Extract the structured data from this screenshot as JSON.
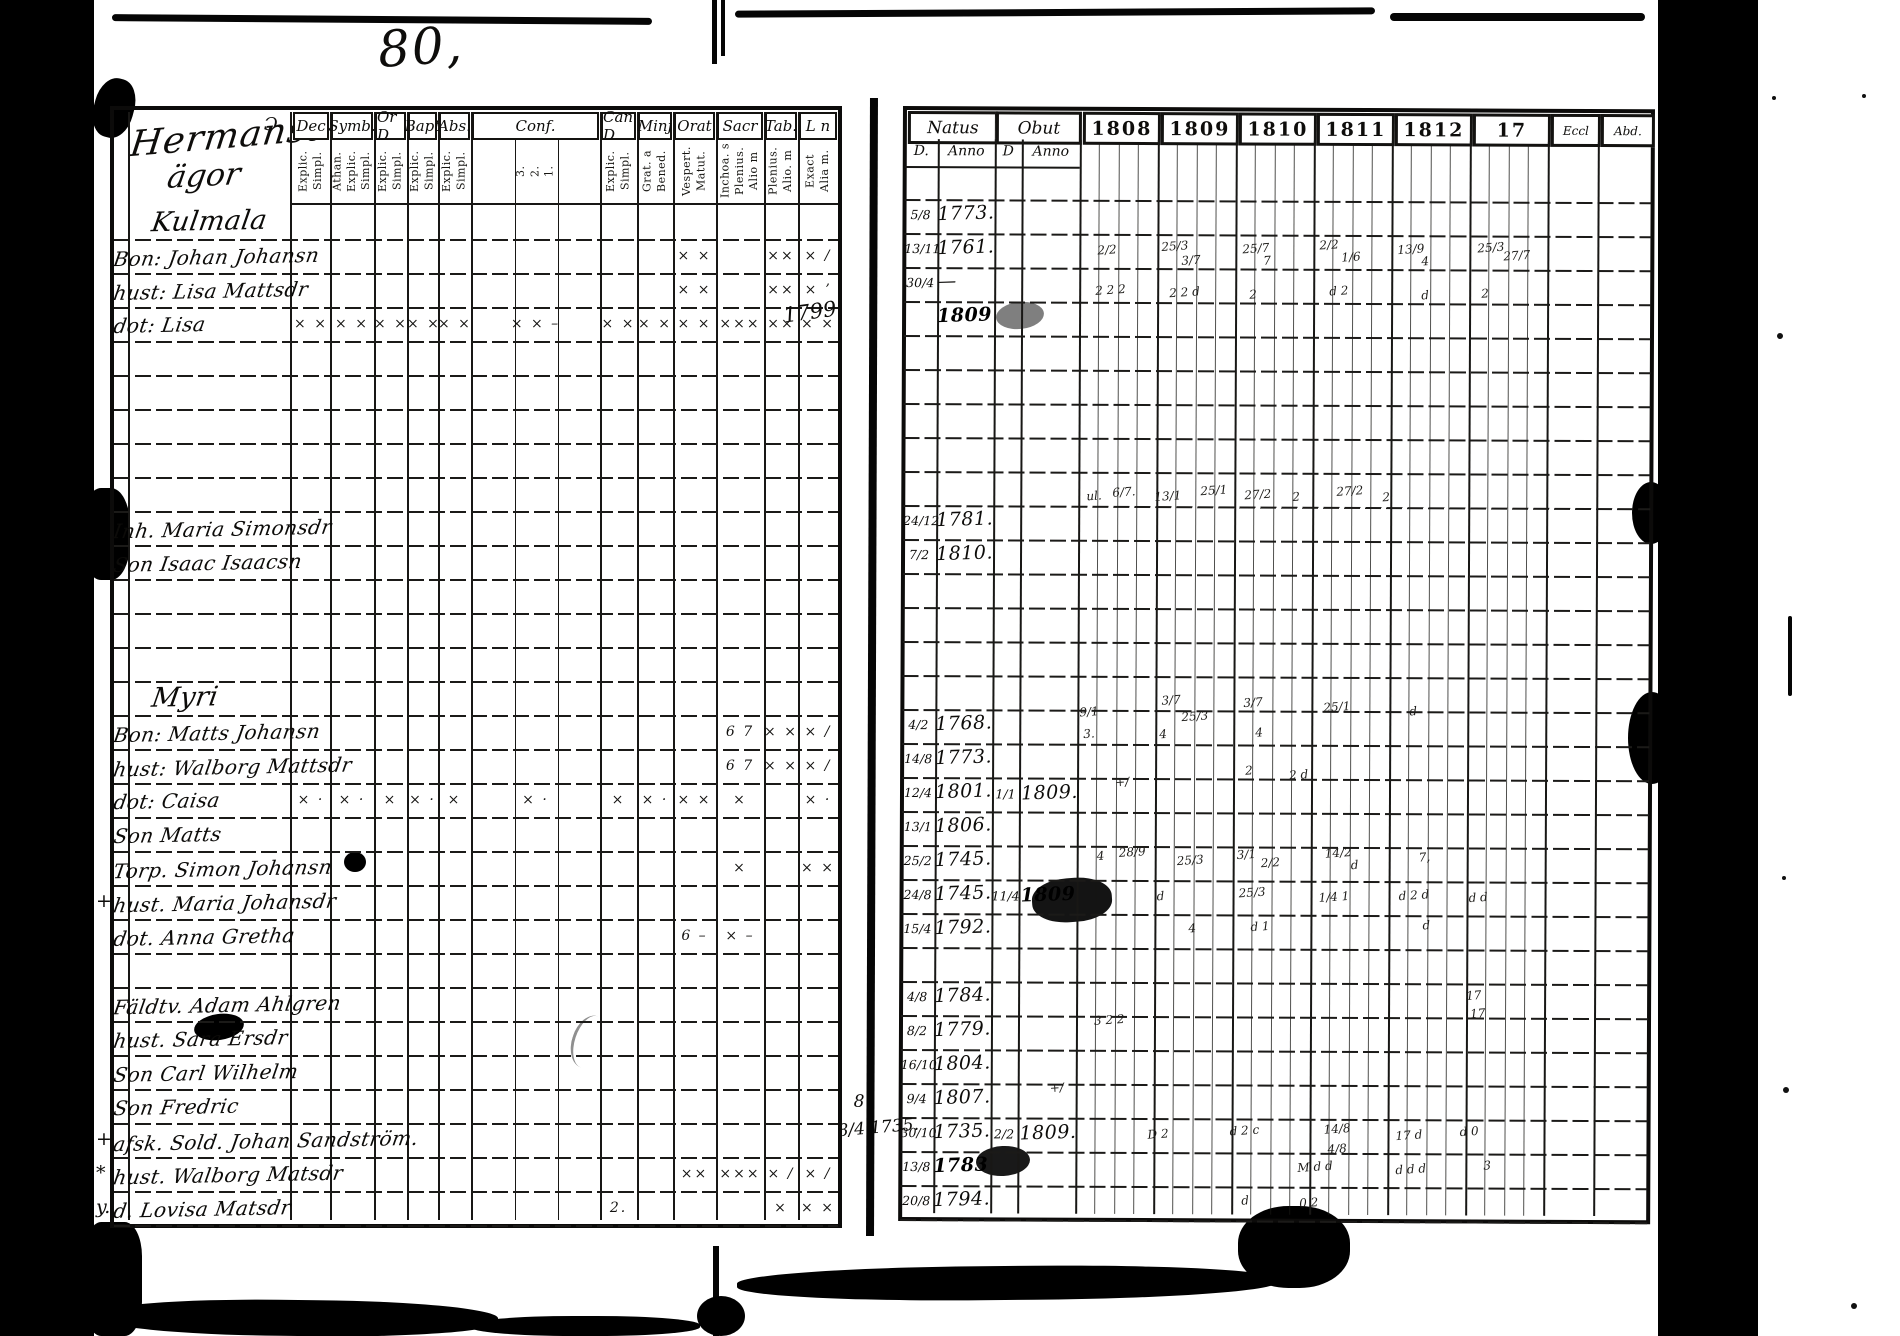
{
  "colors": {
    "paper": "#ffffff",
    "ink": "#0e0d0b",
    "pencil": "#8f8f8f"
  },
  "page_number": "80,",
  "left_page": {
    "title": {
      "line1": "Hermansaro",
      "line2": "ägor",
      "flourish": "Ɔ"
    },
    "columns": [
      {
        "label": "Dec",
        "sub": "Explic.\nSimpl."
      },
      {
        "label": "Symb.",
        "sub": "Athan.\nExplic.\nSimpl."
      },
      {
        "label": "Or D",
        "sub": "Explic.\nSimpl."
      },
      {
        "label": "Bapt",
        "sub": "Explic.\nSimpl."
      },
      {
        "label": "Abs.",
        "sub": "Explic.\nSimpl."
      },
      {
        "label": "Conf.",
        "sub": "3.\n2.\n1."
      },
      {
        "label": "Can D",
        "sub": "Explic.\nSimpl."
      },
      {
        "label": "Minj",
        "sub": "Grat. a\nBened."
      },
      {
        "label": "Orat",
        "sub": "Vespert.\nMatut."
      },
      {
        "label": "Sacr",
        "sub": "Inchoa. s\nPlenius.\nAlio m"
      },
      {
        "label": "Tab.",
        "sub": "Plenius.\nAlio. m"
      },
      {
        "label": "L n",
        "sub": "Exact\nAlia m."
      }
    ],
    "rows": [
      {
        "name": "Kulmala",
        "style": "heading",
        "marks": {}
      },
      {
        "name": "Bon: Johan Johansn",
        "marks": {
          "8": "× ×",
          "10": "××",
          "11": "× /"
        }
      },
      {
        "name": "hust: Lisa Mattsdr",
        "marks": {
          "8": "× ×",
          "10": "××",
          "11": "× ʼ"
        }
      },
      {
        "name": "dot: Lisa",
        "marks": {
          "0": "× ×",
          "1": "× ×",
          "2": "× ×",
          "3": "× ×",
          "4": "× ×",
          "5": "× × –",
          "6": "× ×",
          "7": "× ×",
          "8": "× ×",
          "9": "×××",
          "10": "××",
          "11": "× ×"
        }
      },
      {
        "marks": {}
      },
      {
        "marks": {}
      },
      {
        "marks": {}
      },
      {
        "marks": {}
      },
      {
        "marks": {}
      },
      {
        "name": "Inh. Maria Simonsdr",
        "marks": {}
      },
      {
        "name": "Son Isaac Isaacsn",
        "marks": {}
      },
      {
        "marks": {}
      },
      {
        "marks": {}
      },
      {
        "marks": {}
      },
      {
        "name": "Myri",
        "style": "heading",
        "marks": {}
      },
      {
        "name": "Bon: Matts Johansn",
        "marks": {
          "9": "6  7",
          "10": "× ×",
          "11": "× /"
        }
      },
      {
        "name": "hust: Walborg Mattsdr",
        "marks": {
          "9": "6  7",
          "10": "× ×",
          "11": "× /"
        }
      },
      {
        "name": "dot: Caisa",
        "marks": {
          "0": "× ·",
          "1": "× ·",
          "2": "×",
          "3": "× ·",
          "4": "×",
          "5": "× ·",
          "6": "×",
          "7": "× ·",
          "8": "× ×",
          "9": "×",
          "11": "× ·"
        }
      },
      {
        "name": "Son Matts",
        "marks": {}
      },
      {
        "name": "Torp. Simon Johansn",
        "marks": {
          "9": "×",
          "11": "× ×"
        }
      },
      {
        "name": "hust. Maria Johansdr",
        "marks": {}
      },
      {
        "name": "dot. Anna Gretha",
        "marks": {
          "8": "6 –",
          "9": "× –"
        }
      },
      {
        "marks": {}
      },
      {
        "name": "Fäldtv. Adam Ahlgren",
        "marks": {}
      },
      {
        "name": "hust. Sara Ersdr",
        "marks": {}
      },
      {
        "name": "Son Carl Wilhelm",
        "marks": {}
      },
      {
        "name": "Son Fredric",
        "marks": {}
      },
      {
        "name": "afsk. Sold. Johan Sandström.",
        "marks": {}
      },
      {
        "name": "hust. Walborg Matsdr",
        "marks": {
          "8": "××",
          "9": "×××",
          "10": "× /",
          "11": "× /"
        }
      },
      {
        "name": "d. Lovisa Matsdr",
        "marks": {
          "6": "2.",
          "10": "×",
          "11": "× ×"
        }
      }
    ],
    "margin_marks": [
      {
        "row": 20,
        "text": "+"
      },
      {
        "row": 27,
        "text": "+"
      },
      {
        "row": 28,
        "text": "*"
      },
      {
        "row": 29,
        "text": "y."
      }
    ]
  },
  "right_page": {
    "header": {
      "natus": "Natus",
      "obut": "Obut",
      "d1": "D.",
      "anno1": "Anno",
      "d2": "D",
      "anno2": "Anno"
    },
    "years": [
      "1808",
      "1809",
      "1810",
      "1811",
      "1812",
      "17",
      "Eccl",
      "Abd."
    ],
    "rows": [
      {},
      {
        "nd": "5/8",
        "na": "1773."
      },
      {
        "nd": "13/11",
        "na": "1761."
      },
      {
        "nd": "30/4",
        "na": "—"
      },
      {
        "na": "1809",
        "na_blot": true
      },
      {},
      {},
      {},
      {},
      {},
      {
        "nd": "24/12",
        "na": "1781."
      },
      {
        "nd": "7/2",
        "na": "1810."
      },
      {},
      {},
      {},
      {},
      {
        "nd": "4/2",
        "na": "1768."
      },
      {
        "nd": "14/8",
        "na": "1773."
      },
      {
        "nd": "12/4",
        "na": "1801.",
        "od": "1/1",
        "oa": "1809."
      },
      {
        "nd": "13/1",
        "na": "1806."
      },
      {
        "nd": "25/2",
        "na": "1745."
      },
      {
        "nd": "24/8",
        "na": "1745.",
        "od": "11/4",
        "oa": "1809",
        "oa_blot": true
      },
      {
        "nd": "15/4",
        "na": "1792."
      },
      {},
      {
        "nd": "4/8",
        "na": "1784."
      },
      {
        "nd": "8/2",
        "na": "1779."
      },
      {
        "nd": "16/10",
        "na": "1804."
      },
      {
        "nd": "9/4",
        "na": "1807."
      },
      {
        "nd": "30/10",
        "na": "1735.",
        "od": "2/2",
        "oa": "1809."
      },
      {
        "nd": "13/8",
        "na": "1783",
        "na_blot": true
      },
      {
        "nd": "20/8",
        "na": "1794."
      },
      {}
    ],
    "gutter_notes": [
      {
        "text": "1799.",
        "x": 784,
        "y": 300,
        "size": 21,
        "rot": -8
      },
      {
        "text": "8",
        "x": 858,
        "y": 1092,
        "size": 17,
        "rot": 0
      },
      {
        "text": "8/4 1735.",
        "x": 842,
        "y": 1118,
        "size": 17,
        "rot": -5
      }
    ],
    "annotations": [
      {
        "x": 1098,
        "y": 242,
        "t": "2/2"
      },
      {
        "x": 1162,
        "y": 238,
        "t": "25/3"
      },
      {
        "x": 1182,
        "y": 252,
        "t": "3/7"
      },
      {
        "x": 1243,
        "y": 240,
        "t": "25/7"
      },
      {
        "x": 1264,
        "y": 252,
        "t": "7"
      },
      {
        "x": 1320,
        "y": 236,
        "t": "2/2"
      },
      {
        "x": 1342,
        "y": 248,
        "t": "1/6"
      },
      {
        "x": 1398,
        "y": 240,
        "t": "13/9"
      },
      {
        "x": 1422,
        "y": 252,
        "t": "4"
      },
      {
        "x": 1478,
        "y": 238,
        "t": "25/3"
      },
      {
        "x": 1504,
        "y": 246,
        "t": "27/7"
      },
      {
        "x": 1096,
        "y": 282,
        "t": "2 2 2"
      },
      {
        "x": 1170,
        "y": 284,
        "t": "2 2 d"
      },
      {
        "x": 1250,
        "y": 286,
        "t": "2"
      },
      {
        "x": 1330,
        "y": 282,
        "t": "d 2"
      },
      {
        "x": 1422,
        "y": 286,
        "t": "d"
      },
      {
        "x": 1482,
        "y": 284,
        "t": "2"
      },
      {
        "x": 1088,
        "y": 488,
        "t": "ul."
      },
      {
        "x": 1114,
        "y": 484,
        "t": "6/7."
      },
      {
        "x": 1156,
        "y": 488,
        "t": "13/1"
      },
      {
        "x": 1202,
        "y": 482,
        "t": "25/1"
      },
      {
        "x": 1246,
        "y": 486,
        "t": "27/2"
      },
      {
        "x": 1294,
        "y": 488,
        "t": "2"
      },
      {
        "x": 1338,
        "y": 482,
        "t": "27/2"
      },
      {
        "x": 1384,
        "y": 488,
        "t": "2"
      },
      {
        "x": 1082,
        "y": 704,
        "t": "9/1"
      },
      {
        "x": 1086,
        "y": 726,
        "t": "3."
      },
      {
        "x": 1164,
        "y": 692,
        "t": "3/7"
      },
      {
        "x": 1184,
        "y": 708,
        "t": "25/3"
      },
      {
        "x": 1162,
        "y": 726,
        "t": "4"
      },
      {
        "x": 1246,
        "y": 694,
        "t": "3/7"
      },
      {
        "x": 1258,
        "y": 724,
        "t": "4"
      },
      {
        "x": 1326,
        "y": 698,
        "t": "25/1"
      },
      {
        "x": 1412,
        "y": 702,
        "t": "d"
      },
      {
        "x": 1118,
        "y": 774,
        "t": "+/"
      },
      {
        "x": 1248,
        "y": 762,
        "t": "2"
      },
      {
        "x": 1292,
        "y": 766,
        "t": "2 d"
      },
      {
        "x": 1100,
        "y": 848,
        "t": "4"
      },
      {
        "x": 1122,
        "y": 844,
        "t": "28/9"
      },
      {
        "x": 1180,
        "y": 852,
        "t": "25/3"
      },
      {
        "x": 1240,
        "y": 846,
        "t": "3/1"
      },
      {
        "x": 1264,
        "y": 854,
        "t": "2/2"
      },
      {
        "x": 1328,
        "y": 844,
        "t": "14/2"
      },
      {
        "x": 1354,
        "y": 856,
        "t": "d"
      },
      {
        "x": 1422,
        "y": 848,
        "t": "7,"
      },
      {
        "x": 1160,
        "y": 888,
        "t": "d"
      },
      {
        "x": 1242,
        "y": 884,
        "t": "25/3"
      },
      {
        "x": 1322,
        "y": 888,
        "t": "1/4 1"
      },
      {
        "x": 1402,
        "y": 886,
        "t": "d 2 d"
      },
      {
        "x": 1472,
        "y": 888,
        "t": "d d"
      },
      {
        "x": 1192,
        "y": 920,
        "t": "4"
      },
      {
        "x": 1254,
        "y": 918,
        "t": "d 1"
      },
      {
        "x": 1426,
        "y": 916,
        "t": "d"
      },
      {
        "x": 1470,
        "y": 986,
        "t": "17"
      },
      {
        "x": 1474,
        "y": 1004,
        "t": "17"
      },
      {
        "x": 1098,
        "y": 1012,
        "t": "3 2 2"
      },
      {
        "x": 1054,
        "y": 1080,
        "t": "+/"
      },
      {
        "x": 1152,
        "y": 1126,
        "t": "D 2"
      },
      {
        "x": 1234,
        "y": 1122,
        "t": "d 2 c"
      },
      {
        "x": 1328,
        "y": 1120,
        "t": "14/8"
      },
      {
        "x": 1332,
        "y": 1140,
        "t": "4/8"
      },
      {
        "x": 1400,
        "y": 1126,
        "t": "17 d"
      },
      {
        "x": 1464,
        "y": 1122,
        "t": "d 0"
      },
      {
        "x": 1302,
        "y": 1158,
        "t": "M d d"
      },
      {
        "x": 1400,
        "y": 1160,
        "t": "d d d"
      },
      {
        "x": 1488,
        "y": 1156,
        "t": "3"
      },
      {
        "x": 1246,
        "y": 1192,
        "t": "d"
      },
      {
        "x": 1304,
        "y": 1194,
        "t": "0 2"
      }
    ]
  }
}
